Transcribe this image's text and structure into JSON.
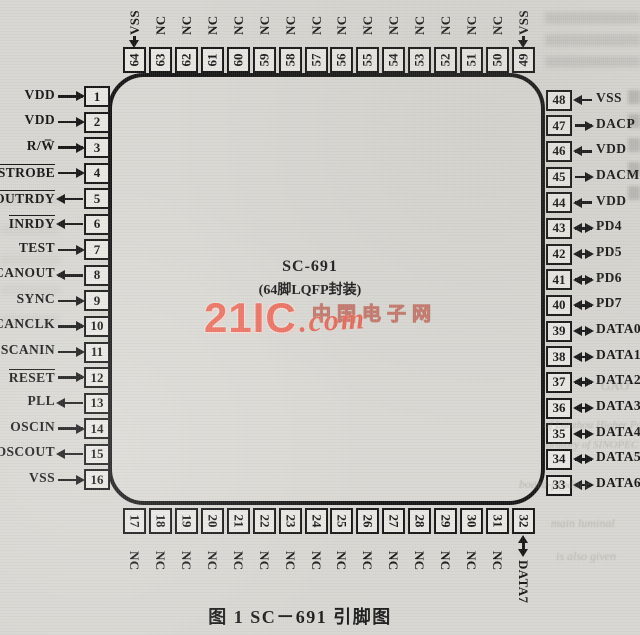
{
  "figure": {
    "chip_name": "SC-691",
    "package_label": "(64脚LQFP封装)",
    "caption": "图 1  SC－691 引脚图"
  },
  "watermark": {
    "brand": "21IC",
    "suffix": ".com",
    "cn_site_name": "中国电子网",
    "accent_color": "#ec7060"
  },
  "pins": {
    "left": [
      {
        "num": 1,
        "label": "VDD",
        "dir": "in",
        "over": false
      },
      {
        "num": 2,
        "label": "VDD",
        "dir": "in",
        "over": false
      },
      {
        "num": 3,
        "label": "R/W̅",
        "dir": "in",
        "over": false
      },
      {
        "num": 4,
        "label": "STROBE",
        "dir": "in",
        "over": true
      },
      {
        "num": 5,
        "label": "OUTRDY",
        "dir": "out",
        "over": true
      },
      {
        "num": 6,
        "label": "INRDY",
        "dir": "out",
        "over": true
      },
      {
        "num": 7,
        "label": "TEST",
        "dir": "in",
        "over": false
      },
      {
        "num": 8,
        "label": "SCANOUT",
        "dir": "out",
        "over": false
      },
      {
        "num": 9,
        "label": "SYNC",
        "dir": "in",
        "over": false
      },
      {
        "num": 10,
        "label": "SCANCLK",
        "dir": "in",
        "over": false
      },
      {
        "num": 11,
        "label": "SCANIN",
        "dir": "in",
        "over": false
      },
      {
        "num": 12,
        "label": "RESET",
        "dir": "in",
        "over": true
      },
      {
        "num": 13,
        "label": "PLL",
        "dir": "out",
        "over": false
      },
      {
        "num": 14,
        "label": "OSCIN",
        "dir": "in",
        "over": false
      },
      {
        "num": 15,
        "label": "OSCOUT",
        "dir": "out",
        "over": false
      },
      {
        "num": 16,
        "label": "VSS",
        "dir": "in",
        "over": false
      }
    ],
    "right": [
      {
        "num": 48,
        "label": "VSS",
        "dir": "in",
        "over": false
      },
      {
        "num": 47,
        "label": "DACP",
        "dir": "out",
        "over": false
      },
      {
        "num": 46,
        "label": "VDD",
        "dir": "in",
        "over": false
      },
      {
        "num": 45,
        "label": "DACM",
        "dir": "out",
        "over": false
      },
      {
        "num": 44,
        "label": "VDD",
        "dir": "in",
        "over": false
      },
      {
        "num": 43,
        "label": "PD4",
        "dir": "bidir",
        "over": false
      },
      {
        "num": 42,
        "label": "PD5",
        "dir": "bidir",
        "over": false
      },
      {
        "num": 41,
        "label": "PD6",
        "dir": "bidir",
        "over": false
      },
      {
        "num": 40,
        "label": "PD7",
        "dir": "bidir",
        "over": false
      },
      {
        "num": 39,
        "label": "DATA0",
        "dir": "bidir",
        "over": false
      },
      {
        "num": 38,
        "label": "DATA1",
        "dir": "bidir",
        "over": false
      },
      {
        "num": 37,
        "label": "DATA2",
        "dir": "bidir",
        "over": false
      },
      {
        "num": 36,
        "label": "DATA3",
        "dir": "bidir",
        "over": false
      },
      {
        "num": 35,
        "label": "DATA4",
        "dir": "bidir",
        "over": false
      },
      {
        "num": 34,
        "label": "DATA5",
        "dir": "bidir",
        "over": false
      },
      {
        "num": 33,
        "label": "DATA6",
        "dir": "bidir",
        "over": false
      }
    ],
    "top": [
      {
        "num": 64,
        "label": "VSS",
        "dir": "in",
        "over": false
      },
      {
        "num": 63,
        "label": "NC",
        "dir": "none",
        "over": false
      },
      {
        "num": 62,
        "label": "NC",
        "dir": "none",
        "over": false
      },
      {
        "num": 61,
        "label": "NC",
        "dir": "none",
        "over": false
      },
      {
        "num": 60,
        "label": "NC",
        "dir": "none",
        "over": false
      },
      {
        "num": 59,
        "label": "NC",
        "dir": "none",
        "over": false
      },
      {
        "num": 58,
        "label": "NC",
        "dir": "none",
        "over": false
      },
      {
        "num": 57,
        "label": "NC",
        "dir": "none",
        "over": false
      },
      {
        "num": 56,
        "label": "NC",
        "dir": "none",
        "over": false
      },
      {
        "num": 55,
        "label": "NC",
        "dir": "none",
        "over": false
      },
      {
        "num": 54,
        "label": "NC",
        "dir": "none",
        "over": false
      },
      {
        "num": 53,
        "label": "NC",
        "dir": "none",
        "over": false
      },
      {
        "num": 52,
        "label": "NC",
        "dir": "none",
        "over": false
      },
      {
        "num": 51,
        "label": "NC",
        "dir": "none",
        "over": false
      },
      {
        "num": 50,
        "label": "NC",
        "dir": "none",
        "over": false
      },
      {
        "num": 49,
        "label": "VSS",
        "dir": "in",
        "over": false
      }
    ],
    "bottom": [
      {
        "num": 17,
        "label": "NC",
        "dir": "none",
        "over": false
      },
      {
        "num": 18,
        "label": "NC",
        "dir": "none",
        "over": false
      },
      {
        "num": 19,
        "label": "NC",
        "dir": "none",
        "over": false
      },
      {
        "num": 20,
        "label": "NC",
        "dir": "none",
        "over": false
      },
      {
        "num": 21,
        "label": "NC",
        "dir": "none",
        "over": false
      },
      {
        "num": 22,
        "label": "NC",
        "dir": "none",
        "over": false
      },
      {
        "num": 23,
        "label": "NC",
        "dir": "none",
        "over": false
      },
      {
        "num": 24,
        "label": "NC",
        "dir": "none",
        "over": false
      },
      {
        "num": 25,
        "label": "NC",
        "dir": "none",
        "over": false
      },
      {
        "num": 26,
        "label": "NC",
        "dir": "none",
        "over": false
      },
      {
        "num": 27,
        "label": "NC",
        "dir": "none",
        "over": false
      },
      {
        "num": 28,
        "label": "NC",
        "dir": "none",
        "over": false
      },
      {
        "num": 29,
        "label": "NC",
        "dir": "none",
        "over": false
      },
      {
        "num": 30,
        "label": "NC",
        "dir": "none",
        "over": false
      },
      {
        "num": 31,
        "label": "NC",
        "dir": "none",
        "over": false
      },
      {
        "num": 32,
        "label": "DATA7",
        "dir": "bidir",
        "over": false
      }
    ]
  },
  "background_fragments": [
    {
      "text": "GAO",
      "x": 601,
      "y": 378,
      "size": 13,
      "italic": false
    },
    {
      "text": "of Lanzhou Higher Poly",
      "x": 544,
      "y": 419,
      "size": 11,
      "italic": true
    },
    {
      "text": "oratory of SINOPEC",
      "x": 546,
      "y": 439,
      "size": 11,
      "italic": true
    },
    {
      "text": "board-produce",
      "x": 519,
      "y": 477,
      "size": 12,
      "italic": true
    },
    {
      "text": "main luminal",
      "x": 551,
      "y": 516,
      "size": 12,
      "italic": true
    },
    {
      "text": "is also given",
      "x": 556,
      "y": 549,
      "size": 12,
      "italic": true
    }
  ]
}
